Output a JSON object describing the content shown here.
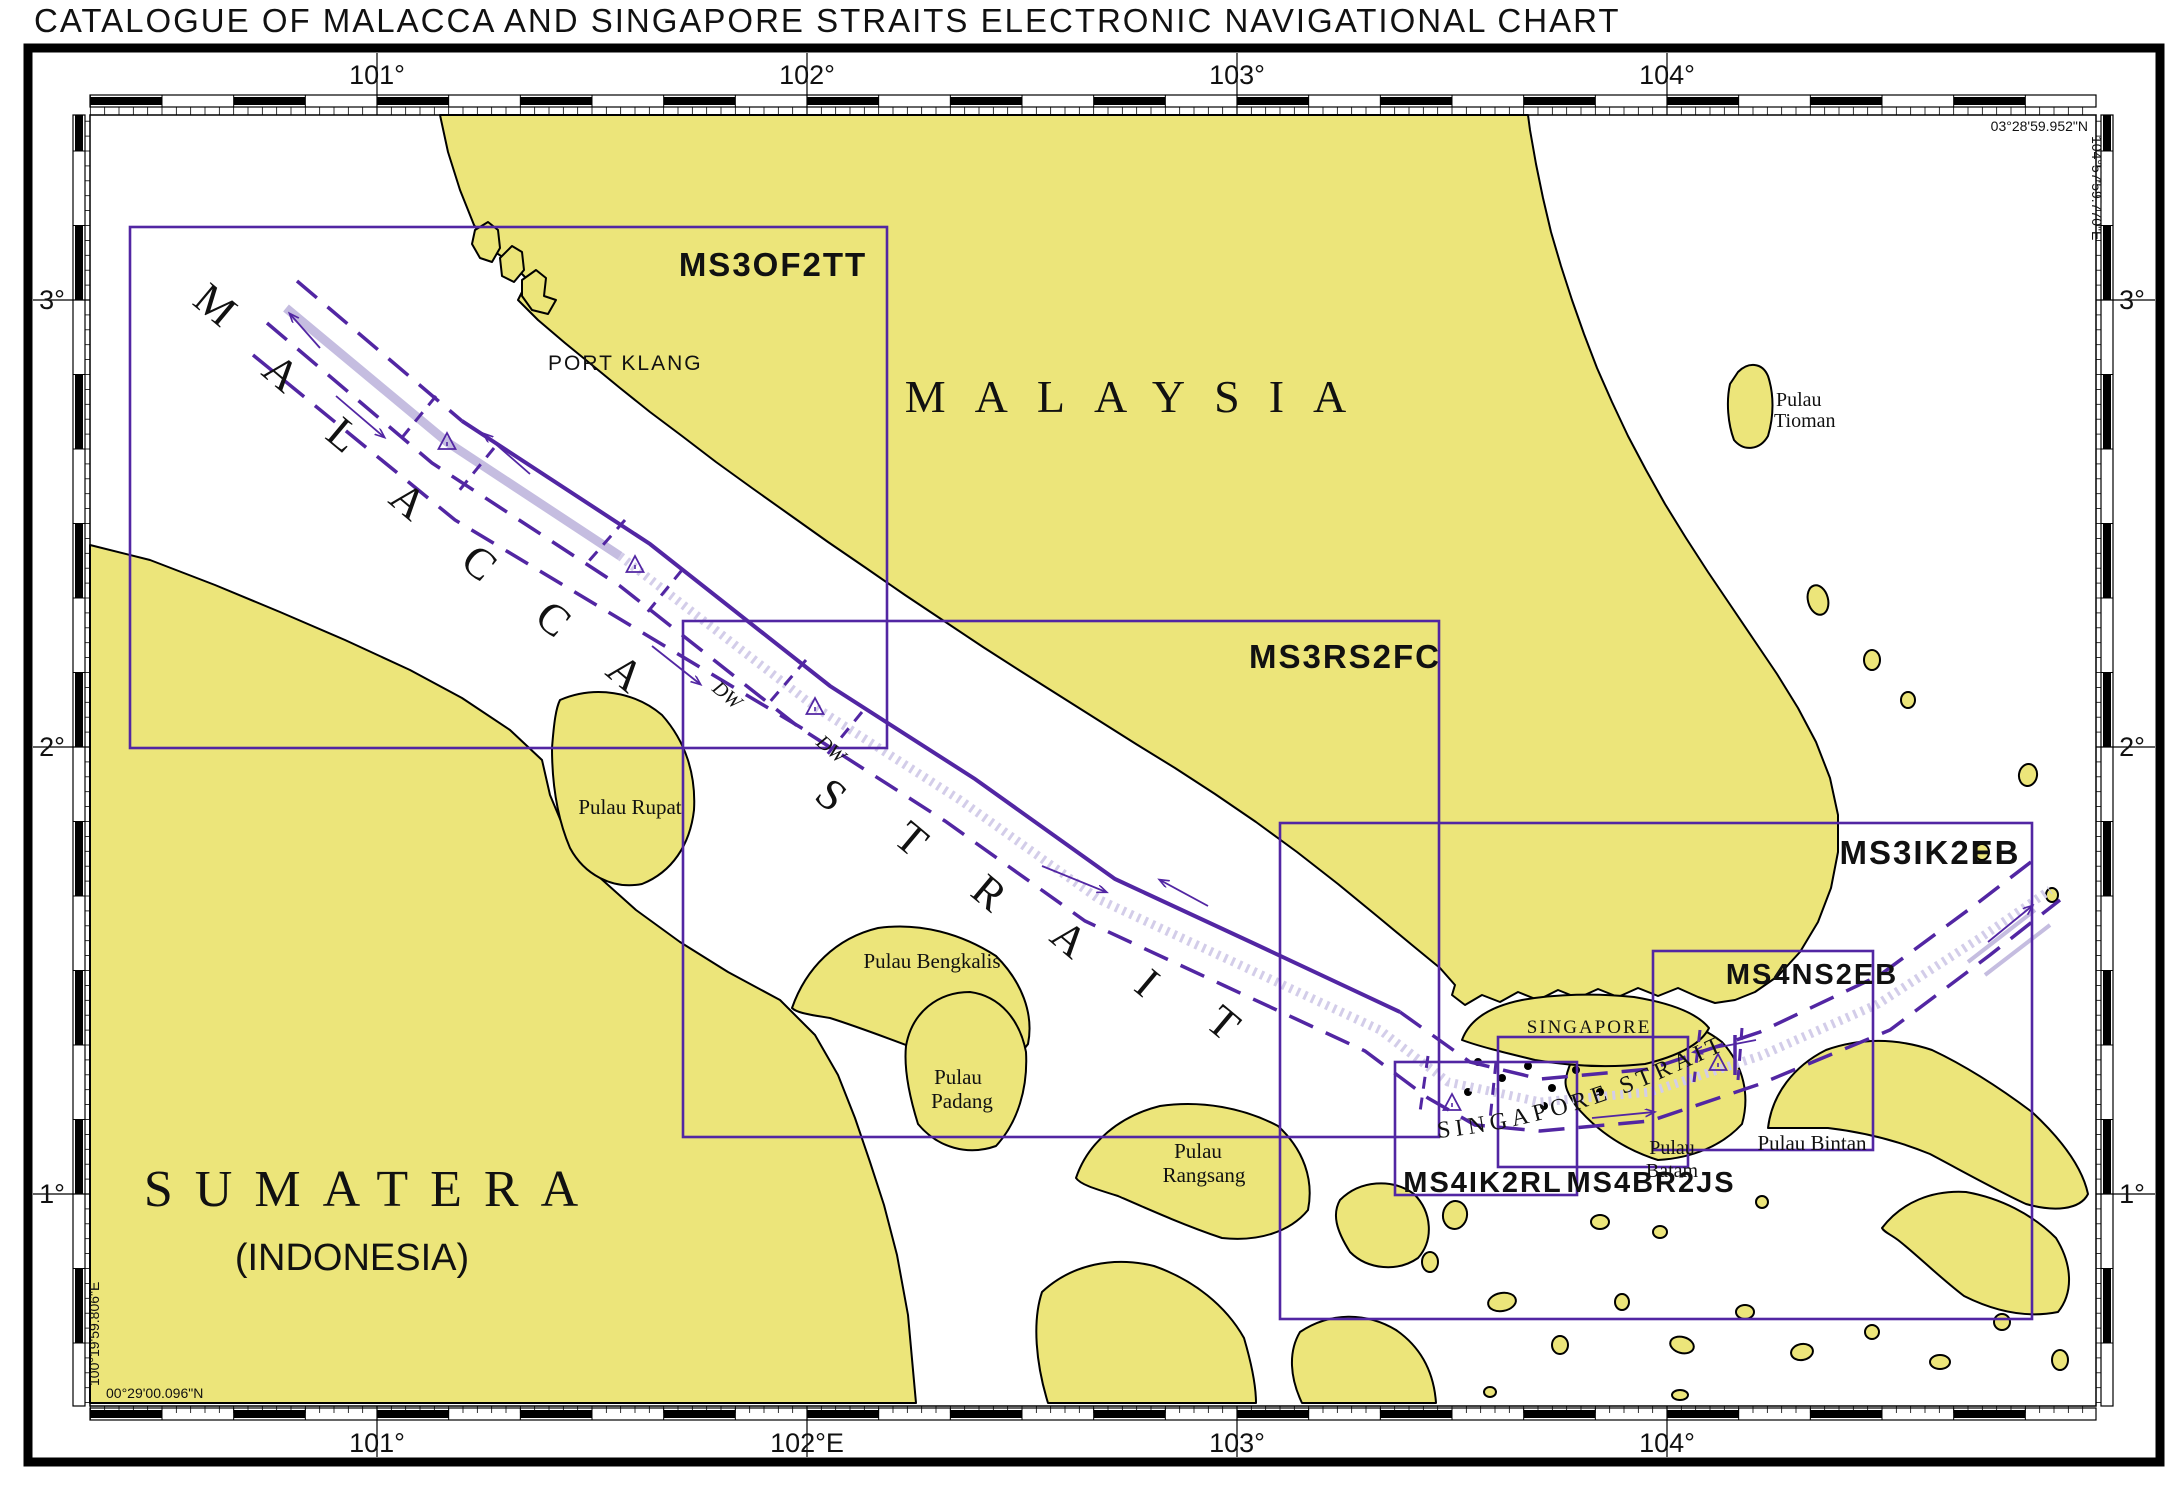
{
  "title": "CATALOGUE OF MALACCA AND SINGAPORE STRAITS ELECTRONIC NAVIGATIONAL CHART",
  "colors": {
    "land": "#ece57a",
    "coast": "#000000",
    "sea": "#ffffff",
    "purple": "#5226a3",
    "lavender": "#c5bde0",
    "stipple": "#d3cde9",
    "frame": "#000000",
    "text": "#111111"
  },
  "graticule": {
    "top": [
      {
        "text": "101°",
        "x": 377
      },
      {
        "text": "102°",
        "x": 807
      },
      {
        "text": "103°",
        "x": 1237
      },
      {
        "text": "104°",
        "x": 1667
      }
    ],
    "bottom": [
      {
        "text": "101°",
        "x": 377
      },
      {
        "text": "102°E",
        "x": 807
      },
      {
        "text": "103°",
        "x": 1237
      },
      {
        "text": "104°",
        "x": 1667
      }
    ],
    "left": [
      {
        "text": "3°",
        "y": 300
      },
      {
        "text": "2°",
        "y": 747
      },
      {
        "text": "1°",
        "y": 1194
      }
    ],
    "right": [
      {
        "text": "3°",
        "y": 300
      },
      {
        "text": "2°",
        "y": 747
      },
      {
        "text": "1°",
        "y": 1194
      }
    ],
    "corners": {
      "top_right_lat": "03°28'59.952\"N",
      "top_right_lon": "104°57'59.770\"E",
      "bottom_left_lat": "00°29'00.096\"N",
      "bottom_left_lon": "100°19'59.806\"E"
    }
  },
  "chart_boxes": [
    {
      "id": "MS3OF2TT",
      "x": 130,
      "y": 227,
      "w": 757,
      "h": 521,
      "lx": 773,
      "ly": 276,
      "fs": 33
    },
    {
      "id": "MS3RS2FC",
      "x": 683,
      "y": 621,
      "w": 756,
      "h": 516,
      "lx": 1345,
      "ly": 668,
      "fs": 33
    },
    {
      "id": "MS3IK2EB",
      "x": 1280,
      "y": 823,
      "w": 752,
      "h": 496,
      "lx": 1930,
      "ly": 864,
      "fs": 33
    },
    {
      "id": "MS4NS2EB",
      "x": 1653,
      "y": 951,
      "w": 220,
      "h": 199,
      "lx": 1812,
      "ly": 984,
      "fs": 29
    },
    {
      "id": "MS4IK2RL",
      "x": 1395,
      "y": 1062,
      "w": 182,
      "h": 133,
      "lx": 1483,
      "ly": 1192,
      "fs": 29
    },
    {
      "id": "MS4BR2JS",
      "x": 1498,
      "y": 1037,
      "w": 190,
      "h": 130,
      "lx": 1651,
      "ly": 1192,
      "fs": 29
    }
  ],
  "strait_letters": {
    "malacca": [
      {
        "ch": "M",
        "x": 206,
        "y": 316
      },
      {
        "ch": "A",
        "x": 272,
        "y": 384
      },
      {
        "ch": "L",
        "x": 334,
        "y": 446
      },
      {
        "ch": "A",
        "x": 399,
        "y": 512
      },
      {
        "ch": "C",
        "x": 470,
        "y": 574
      },
      {
        "ch": "C",
        "x": 544,
        "y": 630
      },
      {
        "ch": "A",
        "x": 616,
        "y": 684
      }
    ],
    "strait": [
      {
        "ch": "S",
        "x": 822,
        "y": 806
      },
      {
        "ch": "T",
        "x": 902,
        "y": 850
      },
      {
        "ch": "R",
        "x": 980,
        "y": 904
      },
      {
        "ch": "A",
        "x": 1060,
        "y": 950
      },
      {
        "ch": "I",
        "x": 1138,
        "y": 994
      },
      {
        "ch": "T",
        "x": 1214,
        "y": 1034
      }
    ]
  },
  "singapore_strait_label": "SINGAPORE STRAIT",
  "map_labels": [
    {
      "name": "label-malaysia",
      "text": "MALAYSIA",
      "x": 1140,
      "y": 412,
      "size": 46,
      "font": "serif",
      "ls": 29,
      "anchor": "middle"
    },
    {
      "name": "label-sumatera",
      "text": "SUMATERA",
      "x": 372,
      "y": 1206,
      "size": 52,
      "font": "serif",
      "ls": 22,
      "anchor": "middle"
    },
    {
      "name": "label-indonesia",
      "text": "(INDONESIA)",
      "x": 352,
      "y": 1270,
      "size": 38,
      "font": "sans",
      "ls": 0,
      "anchor": "middle"
    },
    {
      "name": "label-singapore",
      "text": "SINGAPORE",
      "x": 1589,
      "y": 1033,
      "size": 19,
      "font": "serif",
      "ls": 2,
      "anchor": "middle"
    },
    {
      "name": "label-port-klang",
      "text": "PORT KLANG",
      "x": 548,
      "y": 370,
      "size": 21,
      "font": "sans",
      "ls": 2,
      "anchor": "start"
    },
    {
      "name": "label-pulau-tioman-line1",
      "text": "Pulau",
      "x": 1776,
      "y": 406,
      "size": 20,
      "font": "serif",
      "anchor": "start"
    },
    {
      "name": "label-pulau-tioman-line2",
      "text": "Tioman",
      "x": 1774,
      "y": 427,
      "size": 20,
      "font": "serif",
      "anchor": "start"
    },
    {
      "name": "label-pulau-rupat",
      "text": "Pulau Rupat",
      "x": 630,
      "y": 814,
      "size": 21,
      "font": "serif",
      "anchor": "middle"
    },
    {
      "name": "label-pulau-bengkalis",
      "text": "Pulau Bengkalis",
      "x": 932,
      "y": 968,
      "size": 21,
      "font": "serif",
      "anchor": "middle"
    },
    {
      "name": "label-pulau-padang-line1",
      "text": "Pulau",
      "x": 958,
      "y": 1084,
      "size": 21,
      "font": "serif",
      "anchor": "middle"
    },
    {
      "name": "label-pulau-padang-line2",
      "text": "Padang",
      "x": 962,
      "y": 1108,
      "size": 21,
      "font": "serif",
      "anchor": "middle"
    },
    {
      "name": "label-pulau-rangsang-line1",
      "text": "Pulau",
      "x": 1198,
      "y": 1158,
      "size": 21,
      "font": "serif",
      "anchor": "middle"
    },
    {
      "name": "label-pulau-rangsang-line2",
      "text": "Rangsang",
      "x": 1204,
      "y": 1182,
      "size": 21,
      "font": "serif",
      "anchor": "middle"
    },
    {
      "name": "label-pulau-batam-line1",
      "text": "Pulau",
      "x": 1672,
      "y": 1154,
      "size": 20,
      "font": "serif",
      "anchor": "middle"
    },
    {
      "name": "label-pulau-batam-line2",
      "text": "Batam",
      "x": 1672,
      "y": 1177,
      "size": 20,
      "font": "serif",
      "anchor": "middle"
    },
    {
      "name": "label-pulau-bintan",
      "text": "Pulau Bintan",
      "x": 1812,
      "y": 1150,
      "size": 21,
      "font": "serif",
      "anchor": "middle"
    },
    {
      "name": "label-deepwater-route-1",
      "text": "DW",
      "x": 723,
      "y": 700,
      "size": 20,
      "font": "serif",
      "anchor": "middle",
      "rot": 40,
      "italic": true,
      "color": "purple"
    },
    {
      "name": "label-deepwater-route-2",
      "text": "DW",
      "x": 827,
      "y": 754,
      "size": 20,
      "font": "serif",
      "anchor": "middle",
      "rot": 40,
      "italic": true,
      "color": "purple"
    }
  ]
}
